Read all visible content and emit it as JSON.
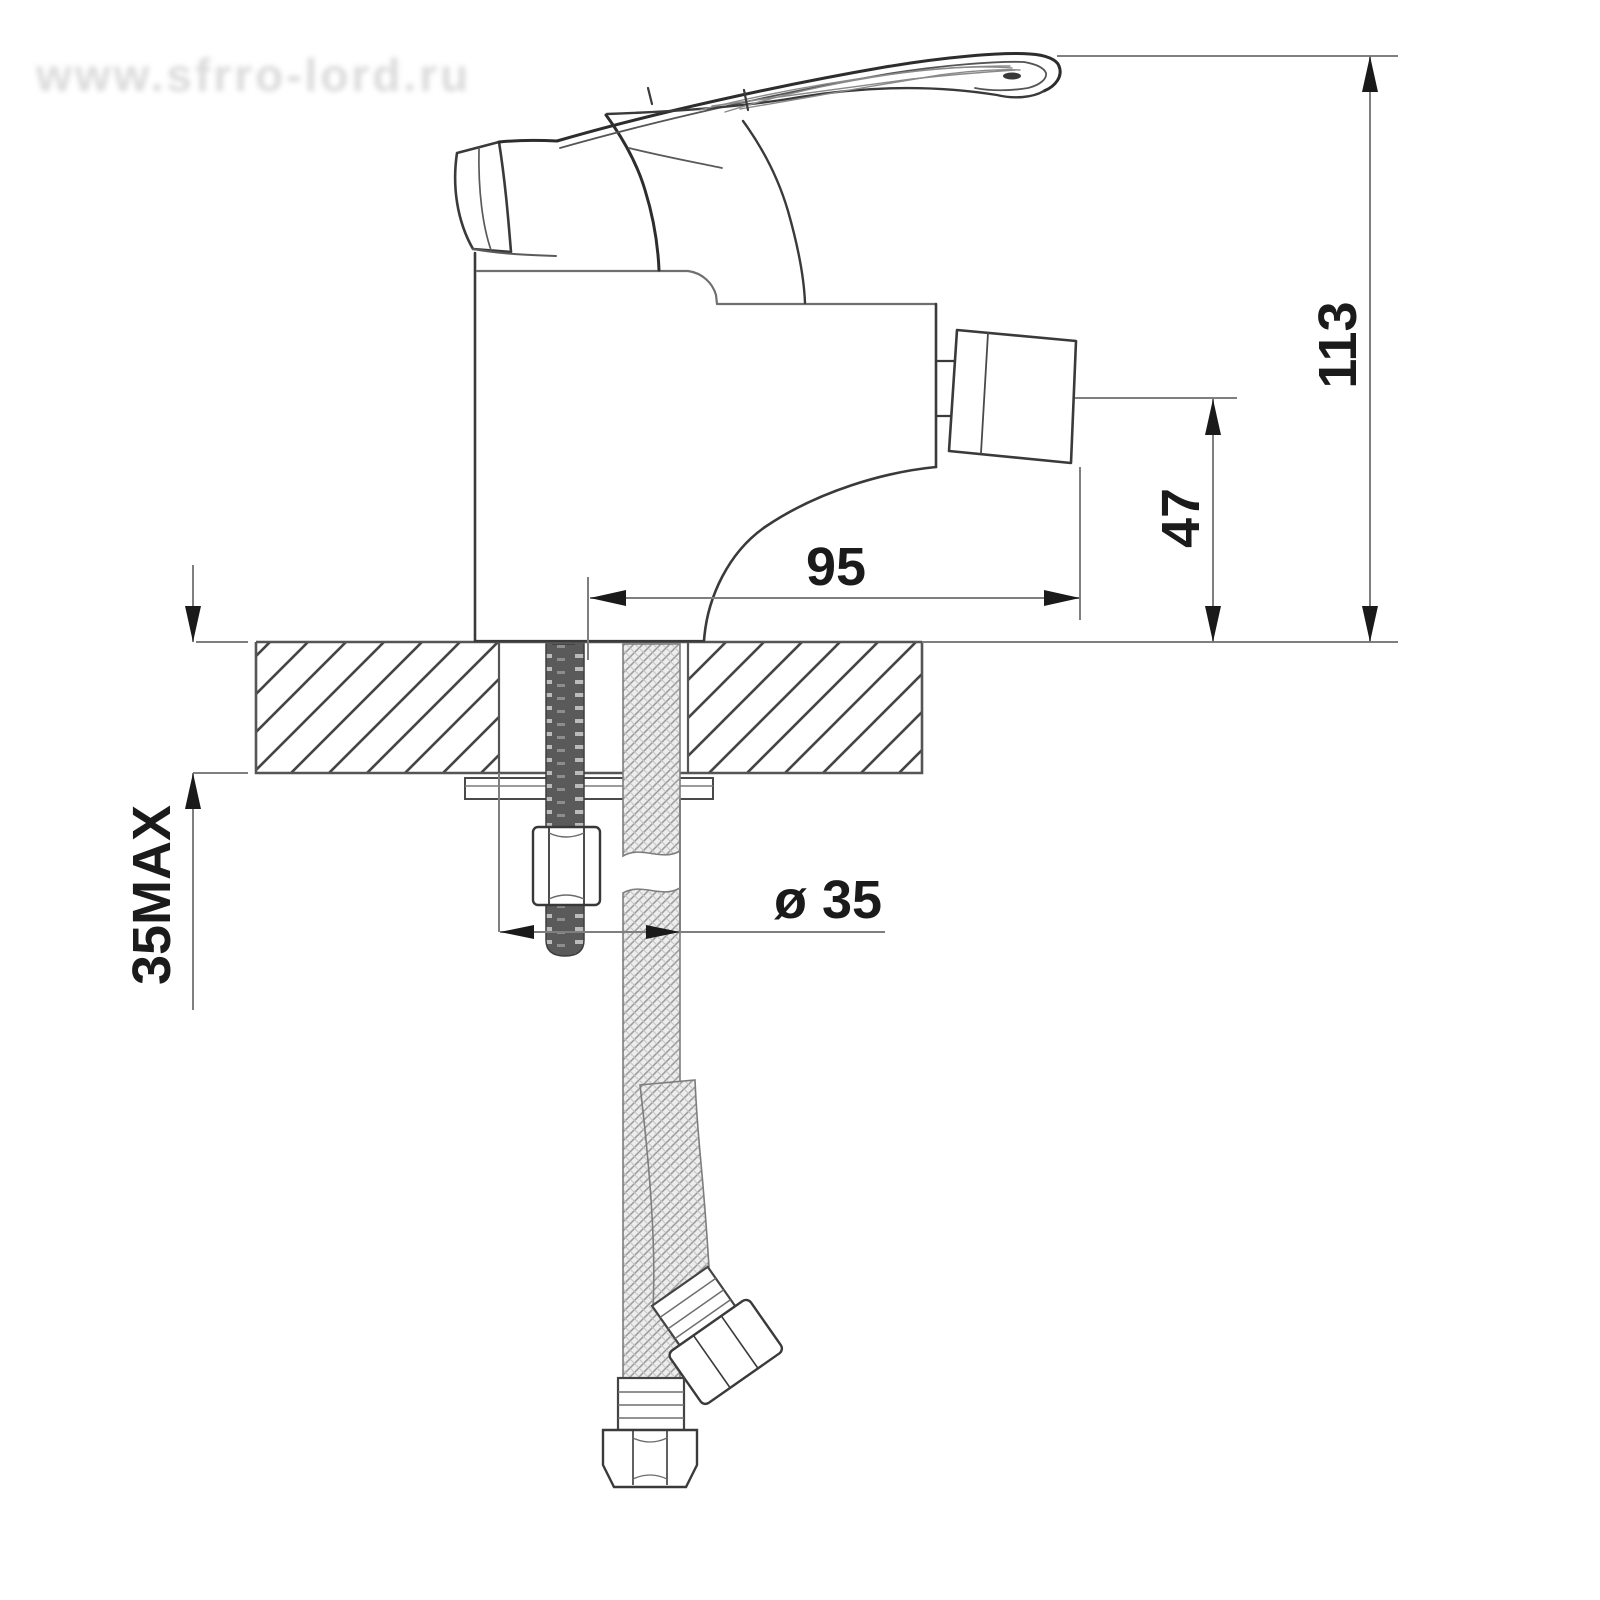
{
  "watermark": {
    "text": "www.sfrro-lord.ru"
  },
  "dimensions": {
    "overall_height": {
      "label": "113",
      "meaning": "overall height above deck, mm"
    },
    "spout_height": {
      "label": "47",
      "meaning": "outlet height above deck, mm"
    },
    "spout_reach": {
      "label": "95",
      "meaning": "axis to outlet face, mm"
    },
    "hole_diameter": {
      "label": "ø 35",
      "meaning": "mounting hole diameter, mm"
    },
    "deck_thickness": {
      "label": "35MAX",
      "meaning": "maximum deck thickness, mm"
    }
  },
  "colors": {
    "outline": "#3a3a3a",
    "dim_line": "#7f7f7f",
    "arrow": "#1a1a1a",
    "hatch": "#454545",
    "braid": "#a0a0a0",
    "background": "#ffffff"
  }
}
